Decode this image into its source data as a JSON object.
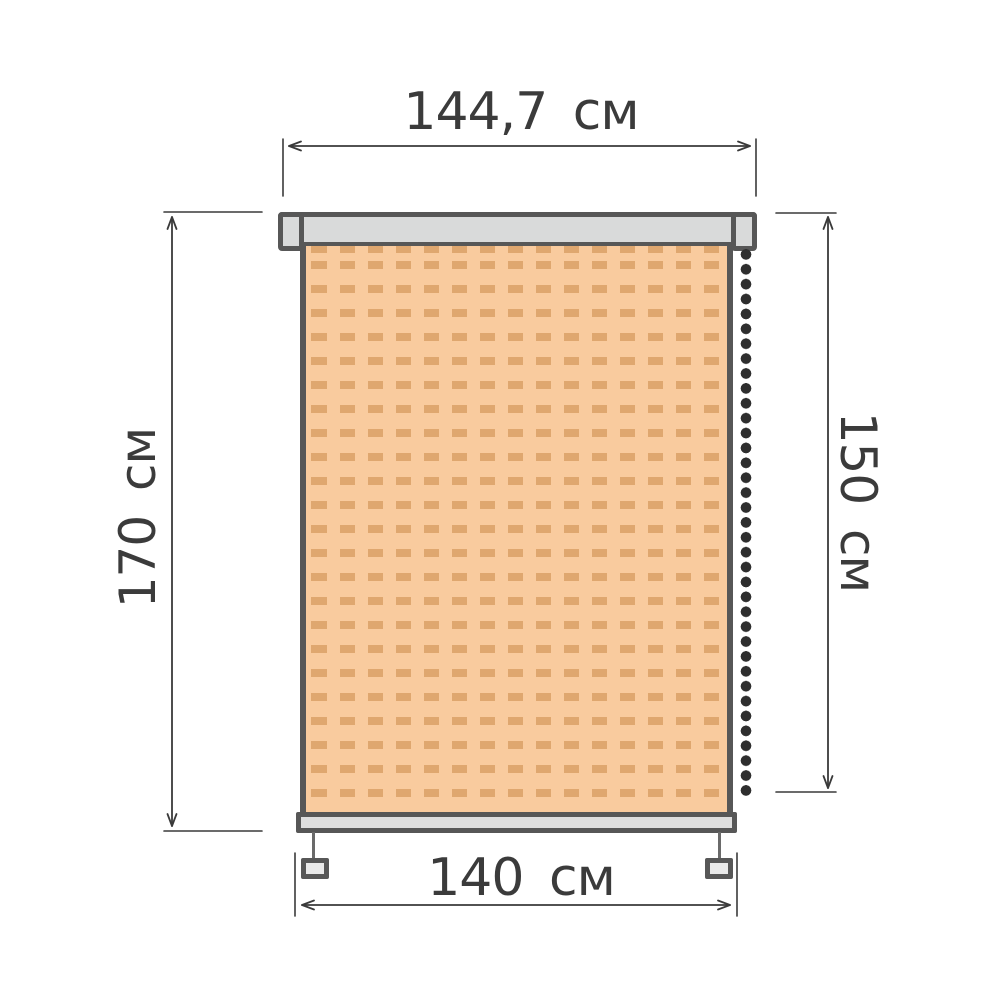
{
  "dimensions": {
    "top_width": "144,7 см",
    "left_height": "170 см",
    "right_height": "150 см",
    "bottom_width": "140 см",
    "top_width_value": 144.7,
    "left_height_value": 170,
    "right_height_value": 150,
    "bottom_width_value": 140,
    "unit": "см"
  },
  "colors": {
    "outline": "#575757",
    "frame_fill": "#d9dada",
    "bar_fill": "#dedede",
    "weight_fill": "#e9e9e9",
    "fabric_bg": "#f9cb9e",
    "fabric_dot": "#dfa76f",
    "chain": "#2e2e2e",
    "line": "#3a3a3a",
    "text": "#3b3b3b"
  }
}
